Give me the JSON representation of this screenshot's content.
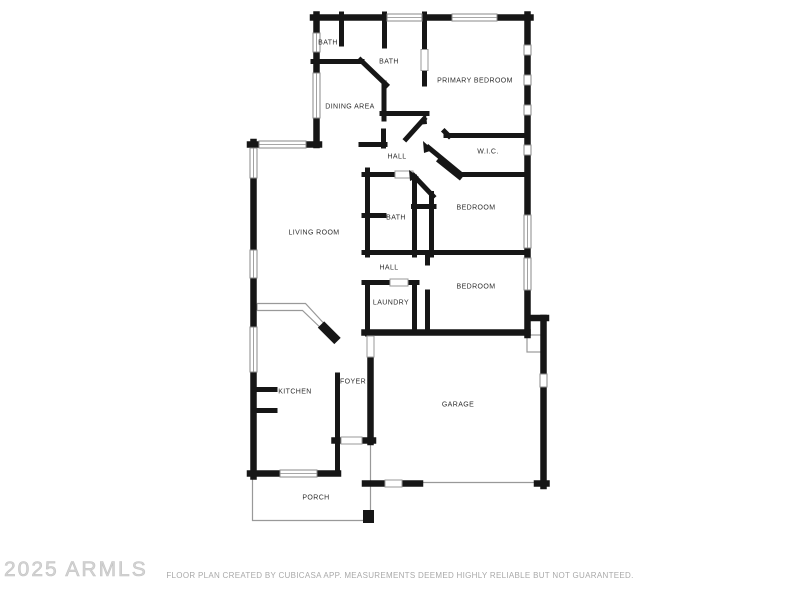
{
  "watermark": {
    "text": "2025 ARMLS"
  },
  "footer": {
    "disclaimer": "FLOOR PLAN CREATED BY CUBICASA APP. MEASUREMENTS DEEMED HIGHLY RELIABLE BUT NOT GUARANTEED."
  },
  "colors": {
    "wall-color": "#161616",
    "label-color": "#2e2e2e",
    "thin-color": "#999999",
    "footer-color": "#a9a9a9",
    "watermark-color": "#d3d3d3",
    "bg-color": "#ffffff"
  },
  "rooms": [
    {
      "id": "bath-1",
      "label": "BATH"
    },
    {
      "id": "bath-2",
      "label": "BATH"
    },
    {
      "id": "primary-bedroom",
      "label": "PRIMARY BEDROOM"
    },
    {
      "id": "dining-area",
      "label": "DINING AREA"
    },
    {
      "id": "hall-1",
      "label": "HALL"
    },
    {
      "id": "wic",
      "label": "W.I.C."
    },
    {
      "id": "living-room",
      "label": "LIVING ROOM"
    },
    {
      "id": "bath-3",
      "label": "BATH"
    },
    {
      "id": "bedroom-1",
      "label": "BEDROOM"
    },
    {
      "id": "hall-2",
      "label": "HALL"
    },
    {
      "id": "laundry",
      "label": "LAUNDRY"
    },
    {
      "id": "bedroom-2",
      "label": "BEDROOM"
    },
    {
      "id": "kitchen",
      "label": "KITCHEN"
    },
    {
      "id": "foyer",
      "label": "FOYER"
    },
    {
      "id": "garage",
      "label": "GARAGE"
    },
    {
      "id": "porch",
      "label": "PORCH"
    }
  ]
}
